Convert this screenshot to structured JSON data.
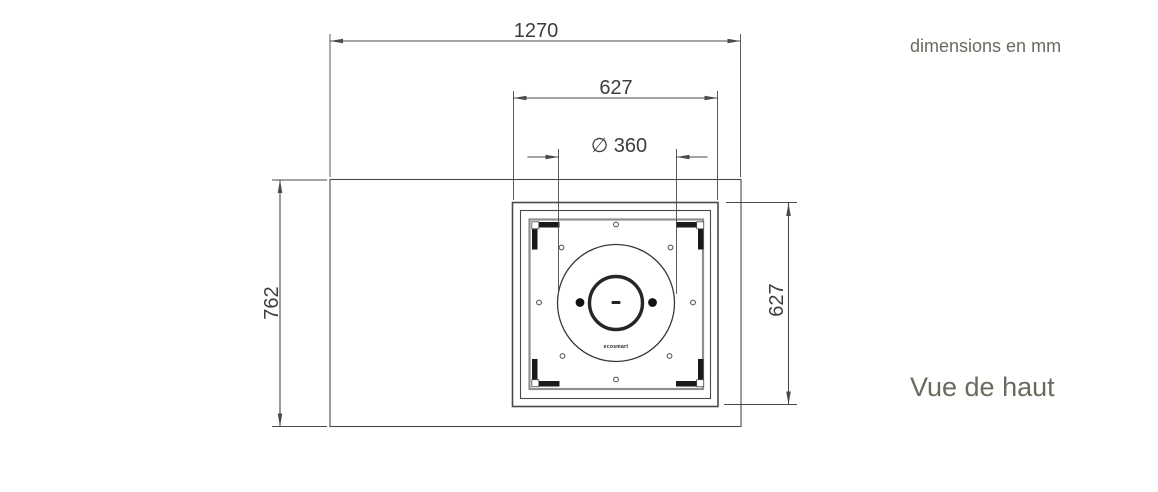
{
  "annotations": {
    "units_note": "dimensions en mm",
    "view_name": "Vue de haut"
  },
  "dimensions": {
    "table_width": "1270",
    "burner_box_width": "627",
    "burner_diameter": "∅ 360",
    "table_depth": "762",
    "burner_box_depth": "627"
  },
  "burner": {
    "brand_mark": "ecosmart"
  },
  "colors": {
    "drawing_line": "#4a4a4a",
    "tray_line": "#8f8f8f",
    "bracket": "#1a1a1a",
    "dimension_text": "#3d3d3d",
    "annotation_text": "#6c6a5f",
    "background": "#ffffff"
  }
}
